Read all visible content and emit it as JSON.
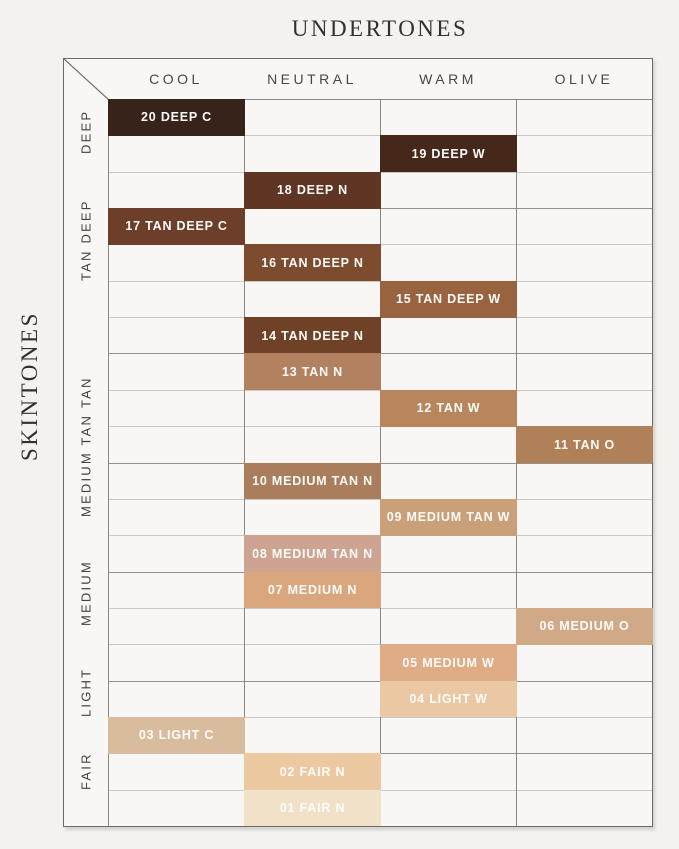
{
  "title": "UNDERTONES",
  "side_title": "SKINTONES",
  "colors": {
    "background": "#f3f2ef",
    "panel": "#f8f7f5",
    "border": "#6e6a64",
    "grid_light": "#cdc9c2",
    "grid_group": "#95918a",
    "heading_text": "#33302c",
    "label_text": "#4b473f",
    "swatch_text": "#fdfcfa"
  },
  "chart_data": {
    "type": "table",
    "title": "UNDERTONES",
    "row_axis_label": "SKINTONES",
    "columns": [
      "COOL",
      "NEUTRAL",
      "WARM",
      "OLIVE"
    ],
    "row_groups": [
      {
        "label": "DEEP",
        "rows": 3
      },
      {
        "label": "TAN DEEP",
        "rows": 4
      },
      {
        "label": "TAN",
        "rows": 3
      },
      {
        "label": "MEDIUM TAN",
        "rows": 3
      },
      {
        "label": "MEDIUM",
        "rows": 3
      },
      {
        "label": "LIGHT",
        "rows": 2
      },
      {
        "label": "FAIR",
        "rows": 2
      }
    ],
    "shades": [
      {
        "label": "20 DEEP C",
        "group": "DEEP",
        "column": "COOL",
        "color": "#38231a"
      },
      {
        "label": "19 DEEP W",
        "group": "DEEP",
        "column": "WARM",
        "color": "#46281a"
      },
      {
        "label": "18 DEEP N",
        "group": "DEEP",
        "column": "NEUTRAL",
        "color": "#5f3523"
      },
      {
        "label": "17 TAN DEEP C",
        "group": "TAN DEEP",
        "column": "COOL",
        "color": "#6d3f2b"
      },
      {
        "label": "16 TAN DEEP N",
        "group": "TAN DEEP",
        "column": "NEUTRAL",
        "color": "#7d4b2e"
      },
      {
        "label": "15 TAN DEEP W",
        "group": "TAN DEEP",
        "column": "WARM",
        "color": "#9a6340"
      },
      {
        "label": "14 TAN DEEP N",
        "group": "TAN DEEP",
        "column": "NEUTRAL",
        "color": "#6f4228"
      },
      {
        "label": "13 TAN N",
        "group": "TAN",
        "column": "NEUTRAL",
        "color": "#b28260"
      },
      {
        "label": "12 TAN W",
        "group": "TAN",
        "column": "WARM",
        "color": "#b9855d"
      },
      {
        "label": "11 TAN O",
        "group": "TAN",
        "column": "OLIVE",
        "color": "#b08159"
      },
      {
        "label": "10 MEDIUM TAN N",
        "group": "MEDIUM TAN",
        "column": "NEUTRAL",
        "color": "#aa7d5c"
      },
      {
        "label": "09 MEDIUM TAN W",
        "group": "MEDIUM TAN",
        "column": "WARM",
        "color": "#c9a078"
      },
      {
        "label": "08 MEDIUM TAN N",
        "group": "MEDIUM TAN",
        "column": "NEUTRAL",
        "color": "#cda491"
      },
      {
        "label": "07 MEDIUM N",
        "group": "MEDIUM",
        "column": "NEUTRAL",
        "color": "#d9a67e"
      },
      {
        "label": "06 MEDIUM O",
        "group": "MEDIUM",
        "column": "OLIVE",
        "color": "#d0a987"
      },
      {
        "label": "05 MEDIUM W",
        "group": "MEDIUM",
        "column": "WARM",
        "color": "#e0ac85"
      },
      {
        "label": "04 LIGHT W",
        "group": "LIGHT",
        "column": "WARM",
        "color": "#eac8a4"
      },
      {
        "label": "03 LIGHT C",
        "group": "LIGHT",
        "column": "COOL",
        "color": "#d9bc9e"
      },
      {
        "label": "02 FAIR N",
        "group": "FAIR",
        "column": "NEUTRAL",
        "color": "#ecc9a1"
      },
      {
        "label": "01 FAIR N",
        "group": "FAIR",
        "column": "NEUTRAL",
        "color": "#f1e1c9"
      }
    ]
  }
}
